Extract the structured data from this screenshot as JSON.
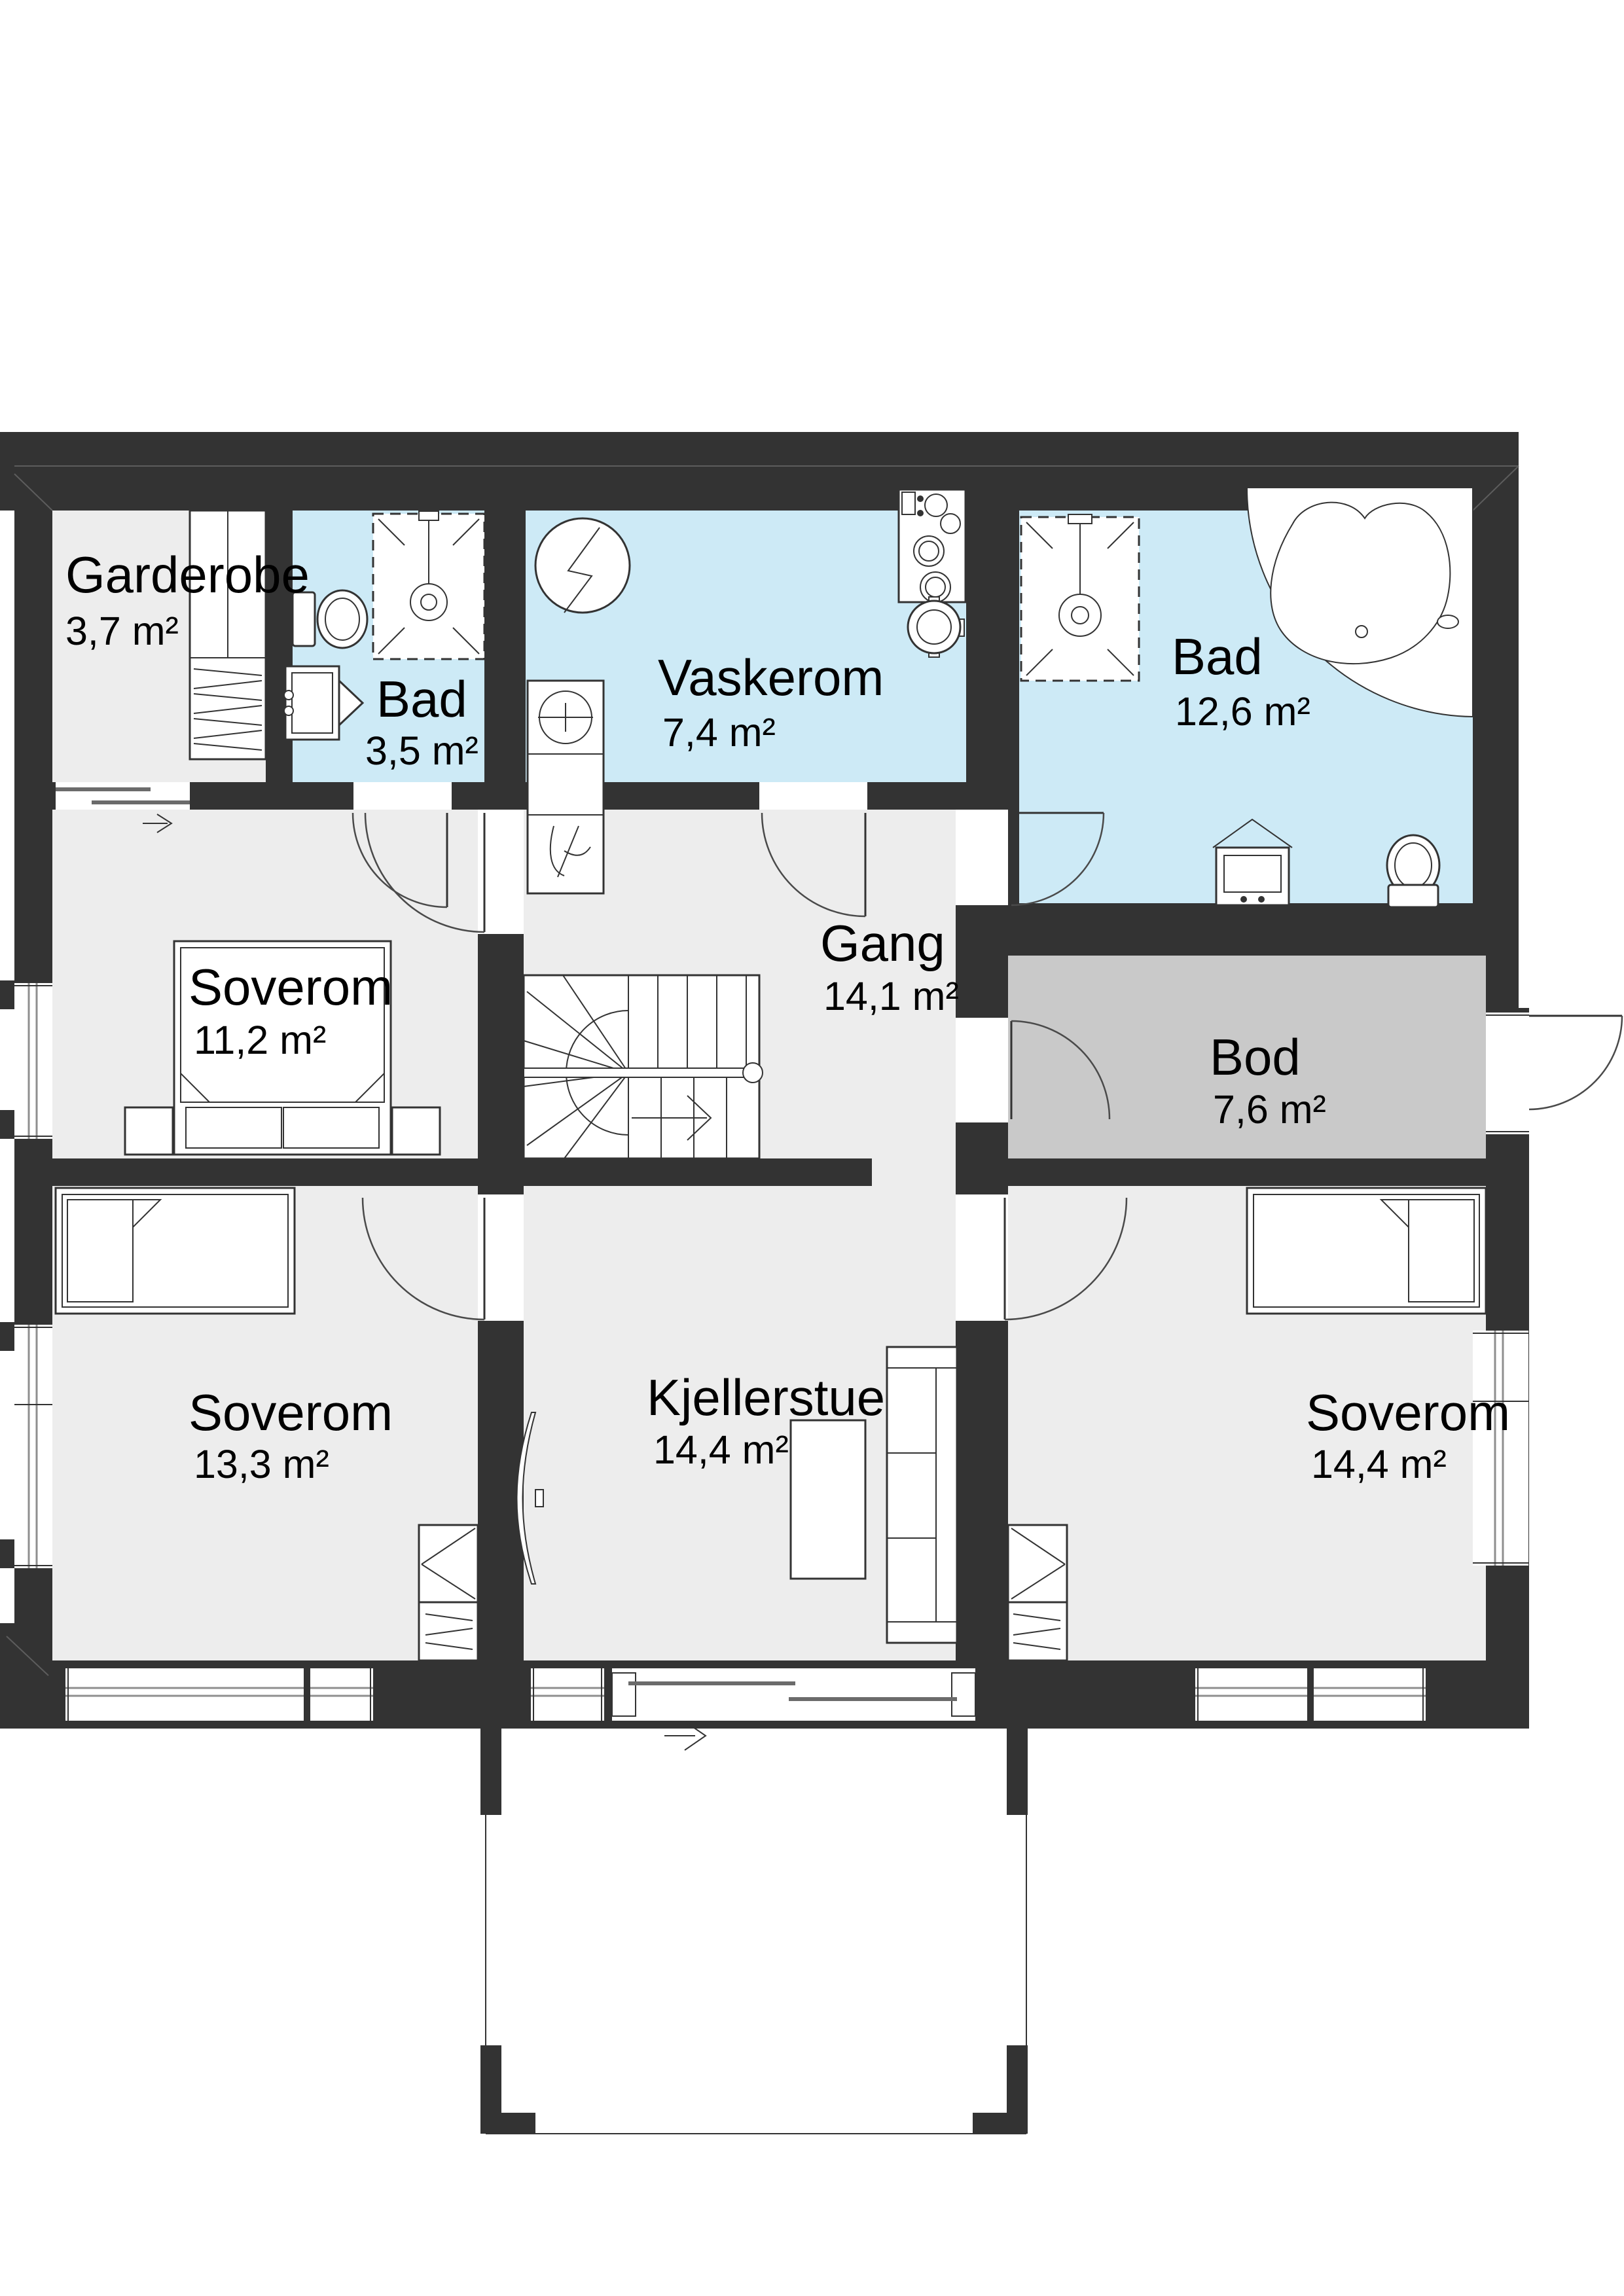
{
  "plan": {
    "type": "floor-plan",
    "rooms": {
      "garderobe": {
        "name": "Garderobe",
        "area": "3,7 m²"
      },
      "bad_small": {
        "name": "Bad",
        "area": "3,5 m²"
      },
      "vaskerom": {
        "name": "Vaskerom",
        "area": "7,4 m²"
      },
      "bad_large": {
        "name": "Bad",
        "area": "12,6 m²"
      },
      "soverom_1": {
        "name": "Soverom",
        "area": "11,2 m²"
      },
      "gang": {
        "name": "Gang",
        "area": "14,1 m²"
      },
      "bod": {
        "name": "Bod",
        "area": "7,6 m²"
      },
      "soverom_2": {
        "name": "Soverom",
        "area": "13,3 m²"
      },
      "kjellerstue": {
        "name": "Kjellerstue",
        "area": "14,4 m²"
      },
      "soverom_3": {
        "name": "Soverom",
        "area": "14,4 m²"
      }
    },
    "colors": {
      "wall": "#333333",
      "floor": "#ededed",
      "wet_room": "#cdeaf6",
      "storage": "#c9c9c9",
      "background": "#ffffff"
    },
    "icons": {
      "direction_arrow": "→"
    }
  }
}
